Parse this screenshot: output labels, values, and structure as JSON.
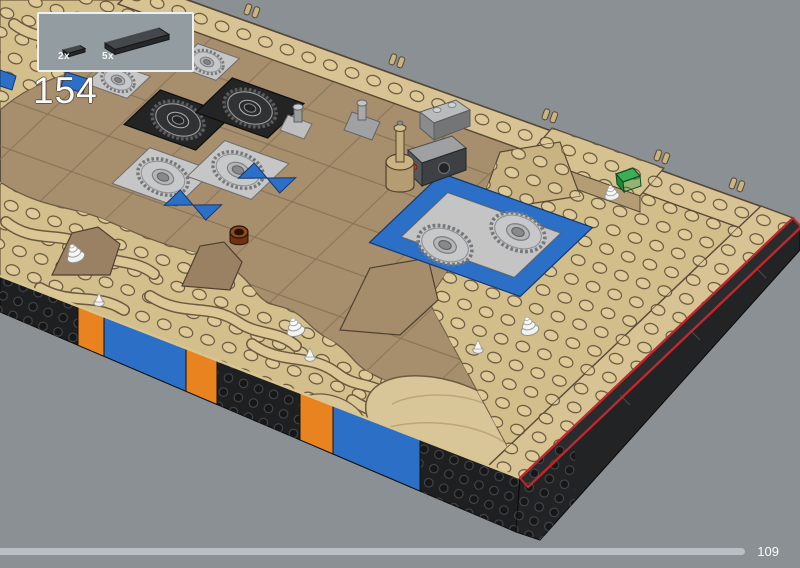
{
  "page": {
    "background_color": "#8A9093"
  },
  "step_panel": {
    "step_number": "154",
    "parts": [
      {
        "quantity_label": "2x",
        "part_name": "small-dark-tile"
      },
      {
        "quantity_label": "5x",
        "part_name": "long-dark-tile"
      }
    ]
  },
  "progress": {
    "page_number": "109",
    "percent_complete": 93
  },
  "model": {
    "deck_color": "#A78E6D",
    "trim_color": "#D7C394",
    "wave_color": "#D3BF8C",
    "wall_color": "#1E1F21",
    "accent_orange": "#E8831F",
    "accent_blue": "#2C6FC7",
    "highlight_color": "#C2272B",
    "gear_silver": "#C7C8C9",
    "green_piece": "#3DAE57",
    "shell_white": "#F2F2F0"
  }
}
